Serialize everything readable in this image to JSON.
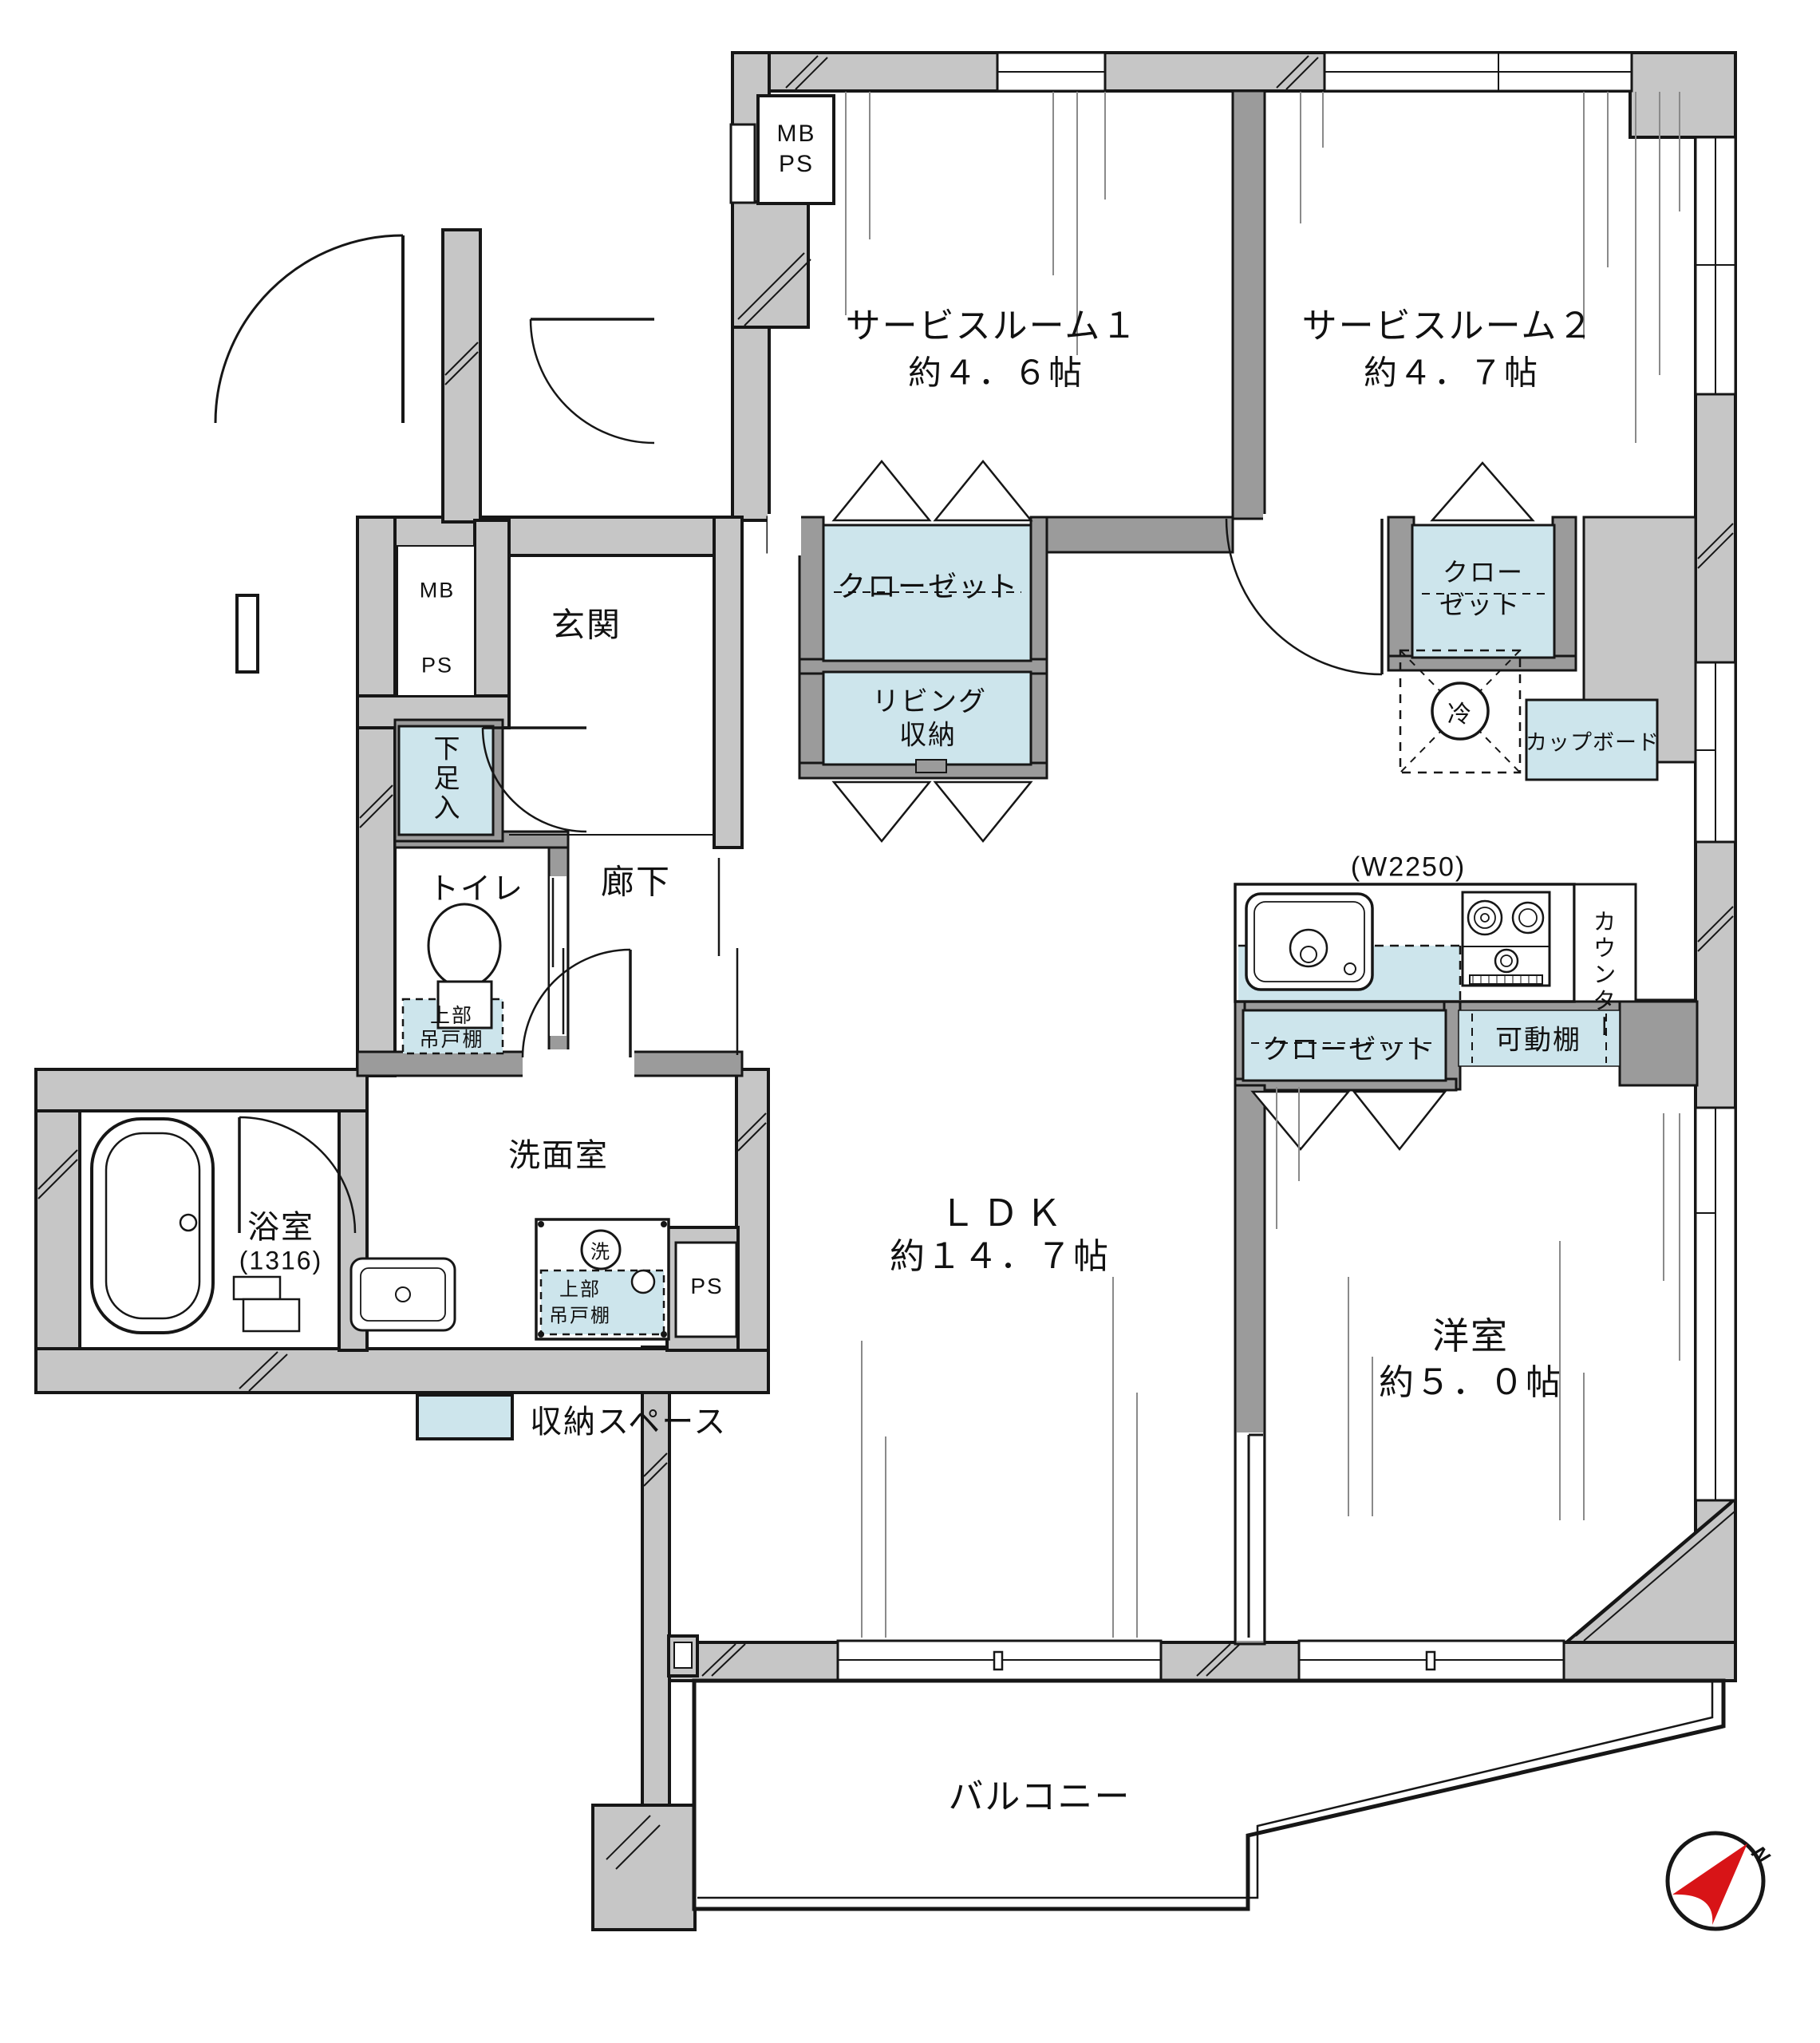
{
  "rooms": {
    "service_room_1": {
      "name": "サービスルーム１",
      "size": "約４．６帖"
    },
    "service_room_2": {
      "name": "サービスルーム２",
      "size": "約４．７帖"
    },
    "ldk": {
      "name": "ＬＤＫ",
      "size": "約１４．７帖"
    },
    "western_room": {
      "name": "洋室",
      "size": "約５．０帖"
    },
    "entrance": "玄関",
    "hallway": "廊下",
    "toilet": "トイレ",
    "washroom": "洗面室",
    "bathroom": {
      "name": "浴室",
      "size": "(1316)"
    },
    "balcony": "バルコニー"
  },
  "storage": {
    "closet_sr1": "クローゼット",
    "living_storage_l1": "リビング",
    "living_storage_l2": "収納",
    "closet_sr2_l1": "クロー",
    "closet_sr2_l2": "ゼット",
    "closet_west": "クローゼット",
    "movable_shelf": "可動棚",
    "cupboard": "カップボード",
    "shoe_box": "下足入",
    "upper_cabinet_l1": "上部",
    "upper_cabinet_l2": "吊戸棚"
  },
  "kitchen": {
    "width_note": "(W2250)",
    "counter": "カウンター"
  },
  "utility": {
    "mb": "MB",
    "ps": "PS",
    "refrigerator": "冷",
    "washer": "洗"
  },
  "legend": {
    "storage_space": "収納スペース"
  },
  "compass": {
    "north": "N"
  },
  "colors": {
    "wall": "#c6c6c6",
    "partition": "#9b9b9b",
    "storage_fill": "#cde5ec",
    "compass_needle": "#d81417"
  }
}
